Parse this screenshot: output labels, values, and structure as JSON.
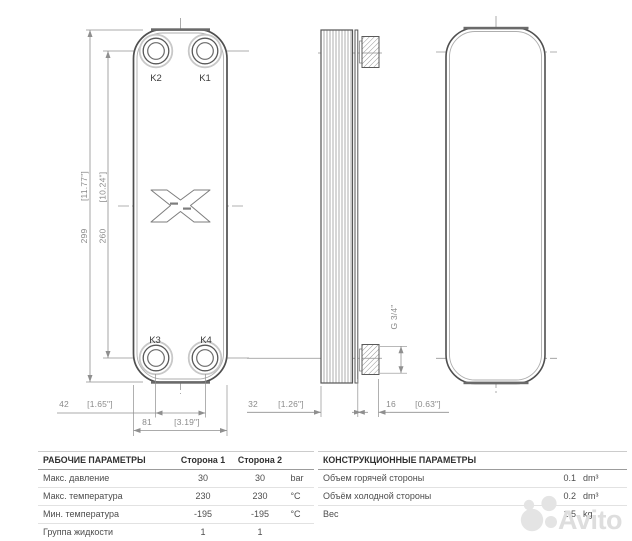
{
  "drawing": {
    "ports": {
      "k1": "K1",
      "k2": "K2",
      "k3": "K3",
      "k4": "K4"
    },
    "dims": {
      "height": {
        "mm": "299",
        "in": "[11.77\"]"
      },
      "ports_v": {
        "mm": "260",
        "in": "[10.24\"]"
      },
      "ports_h": {
        "mm": "42",
        "in": "[1.65\"]"
      },
      "width": {
        "mm": "81",
        "in": "[3.19\"]"
      },
      "depth": {
        "mm": "32",
        "in": "[1.26\"]"
      },
      "conn": {
        "mm": "16",
        "in": "[0.63\"]"
      },
      "thread": "G 3/4\""
    }
  },
  "tables": {
    "working": {
      "title": "РАБОЧИЕ ПАРАМЕТРЫ",
      "col1": "Сторона 1",
      "col2": "Сторона 2",
      "rows": [
        {
          "name": "Макс. давление",
          "v1": "30",
          "v2": "30",
          "unit": "bar"
        },
        {
          "name": "Макс. температура",
          "v1": "230",
          "v2": "230",
          "unit": "°C"
        },
        {
          "name": "Мин. температура",
          "v1": "-195",
          "v2": "-195",
          "unit": "°C"
        },
        {
          "name": "Группа жидкости",
          "v1": "1",
          "v2": "1",
          "unit": ""
        }
      ]
    },
    "construction": {
      "title": "КОНСТРУКЦИОННЫЕ ПАРАМЕТРЫ",
      "rows": [
        {
          "name": "Объем горячей стороны",
          "value": "0.1",
          "unit": "dm³"
        },
        {
          "name": "Объём холодной стороны",
          "value": "0.2",
          "unit": "dm³"
        },
        {
          "name": "Вес",
          "value": "1.5",
          "unit": "kg"
        }
      ]
    }
  },
  "watermark": {
    "text": "Avito"
  },
  "colors": {
    "line_dark": "#4f4f4f",
    "line_dim": "#8f8f8f",
    "watermark": "#dedede"
  }
}
